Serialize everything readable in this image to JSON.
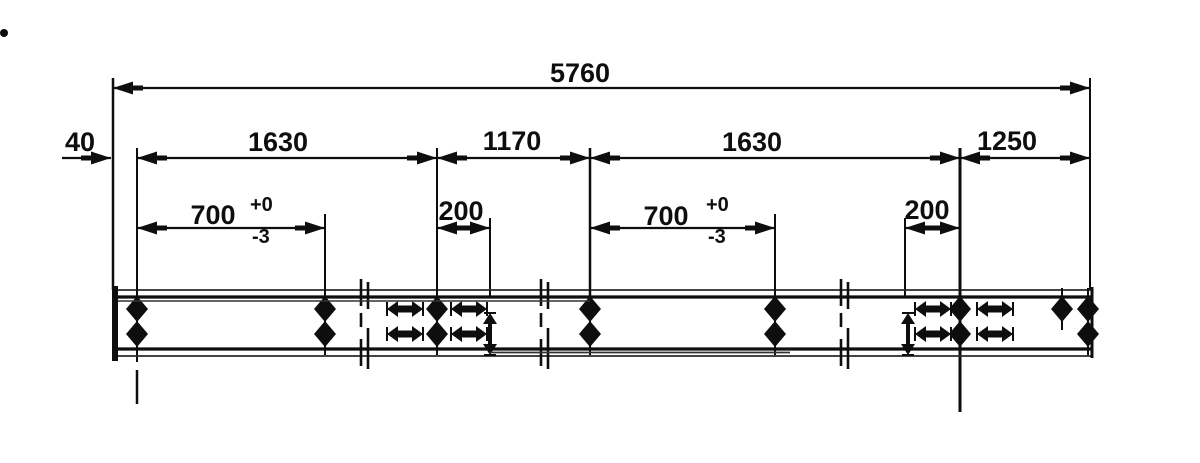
{
  "meta": {
    "kind": "engineering-dimension-drawing",
    "ink": "#0e0e0e",
    "paper": "#ffffff"
  },
  "dimensions": [
    {
      "value": "5760"
    },
    {
      "value": "40"
    },
    {
      "value": "1630"
    },
    {
      "value": "1170"
    },
    {
      "value": "1630"
    },
    {
      "value": "1250"
    },
    {
      "value": "700",
      "tolerance_plus": "+0",
      "tolerance_minus": "-3"
    },
    {
      "value": "200"
    },
    {
      "value": "700",
      "tolerance_plus": "+0",
      "tolerance_minus": "-3"
    },
    {
      "value": "200"
    }
  ],
  "drawing": {
    "width": 1200,
    "height": 463,
    "dim_rows": [
      {
        "name": "overall-5760",
        "label": "5760",
        "x1": 113,
        "x2": 1090,
        "y": 88,
        "label_x": 580,
        "label_y": 82
      },
      {
        "name": "offset-40",
        "label": "40",
        "x1": 62,
        "x2": 111,
        "y": 158,
        "label_x": 80,
        "label_y": 151,
        "arrows": "right-only"
      },
      {
        "name": "span-1630-left",
        "label": "1630",
        "x1": 137,
        "x2": 437,
        "y": 158,
        "label_x": 278,
        "label_y": 151
      },
      {
        "name": "span-1170",
        "label": "1170",
        "x1": 437,
        "x2": 590,
        "y": 158,
        "label_x": 512,
        "label_y": 150
      },
      {
        "name": "span-1630-right",
        "label": "1630",
        "x1": 590,
        "x2": 960,
        "y": 158,
        "label_x": 752,
        "label_y": 151
      },
      {
        "name": "span-1250",
        "label": "1250",
        "x1": 960,
        "x2": 1090,
        "y": 158,
        "label_x": 1007,
        "label_y": 150
      },
      {
        "name": "span-700-left",
        "label": "700",
        "tol_plus": "+0",
        "tol_minus": "-3",
        "x1": 137,
        "x2": 325,
        "y": 228,
        "label_x": 213,
        "label_y": 224,
        "tol_x": 250
      },
      {
        "name": "span-200-left",
        "label": "200",
        "x1": 437,
        "x2": 490,
        "y": 228,
        "label_x": 461,
        "label_y": 220
      },
      {
        "name": "span-700-right",
        "label": "700",
        "tol_plus": "+0",
        "tol_minus": "-3",
        "x1": 590,
        "x2": 775,
        "y": 228,
        "label_x": 666,
        "label_y": 225,
        "tol_x": 706
      },
      {
        "name": "span-200-right",
        "label": "200",
        "x1": 905,
        "x2": 960,
        "y": 228,
        "label_x": 927,
        "label_y": 219
      }
    ],
    "ext_lines": [
      {
        "x": 113,
        "y1": 78,
        "y2": 290,
        "w": 2.5
      },
      {
        "x": 1090,
        "y1": 78,
        "y2": 290,
        "w": 2
      },
      {
        "x": 137,
        "y1": 148,
        "y2": 362,
        "w": 2
      },
      {
        "x": 137,
        "y1": 370,
        "y2": 404,
        "w": 2.5
      },
      {
        "x": 437,
        "y1": 148,
        "y2": 300,
        "w": 2
      },
      {
        "x": 590,
        "y1": 148,
        "y2": 303,
        "w": 2.5
      },
      {
        "x": 960,
        "y1": 148,
        "y2": 412,
        "w": 3
      },
      {
        "x": 325,
        "y1": 214,
        "y2": 300,
        "w": 2
      },
      {
        "x": 490,
        "y1": 218,
        "y2": 296,
        "w": 2
      },
      {
        "x": 775,
        "y1": 214,
        "y2": 303,
        "w": 2
      },
      {
        "x": 905,
        "y1": 218,
        "y2": 296,
        "w": 2
      }
    ],
    "beam": {
      "x1": 113,
      "x2": 1093,
      "top_outer": 290,
      "top_inner": 297,
      "bot_inner": 349,
      "bot_outer": 356,
      "cap_left_x": 115,
      "cap_right_x": 1092
    },
    "breaks": [
      365,
      545,
      845
    ],
    "sym_rows": {
      "top": 309,
      "bottom": 334
    },
    "symbols": [
      {
        "type": "diamond",
        "x": 137,
        "rows": [
          "top",
          "bottom"
        ]
      },
      {
        "type": "diamond",
        "x": 325,
        "rows": [
          "top",
          "bottom"
        ]
      },
      {
        "type": "h-arrow",
        "x": 405,
        "rows": [
          "top",
          "bottom"
        ]
      },
      {
        "type": "diamond",
        "x": 437,
        "rows": [
          "top",
          "bottom"
        ]
      },
      {
        "type": "h-arrow",
        "x": 469,
        "rows": [
          "top",
          "bottom"
        ]
      },
      {
        "type": "v-arrow",
        "x": 490,
        "rows": [
          "bottom"
        ]
      },
      {
        "type": "diamond",
        "x": 590,
        "rows": [
          "top",
          "bottom"
        ]
      },
      {
        "type": "diamond",
        "x": 775,
        "rows": [
          "top",
          "bottom"
        ]
      },
      {
        "type": "v-arrow",
        "x": 908,
        "rows": [
          "bottom"
        ]
      },
      {
        "type": "h-arrow",
        "x": 933,
        "rows": [
          "top",
          "bottom"
        ]
      },
      {
        "type": "diamond",
        "x": 960,
        "rows": [
          "top",
          "bottom"
        ]
      },
      {
        "type": "h-arrow",
        "x": 995,
        "rows": [
          "top",
          "bottom"
        ]
      },
      {
        "type": "diamond",
        "x": 1062,
        "rows": [
          "top"
        ]
      },
      {
        "type": "diamond",
        "x": 1088,
        "rows": [
          "top",
          "bottom"
        ]
      }
    ],
    "artifacts": [
      {
        "type": "speck",
        "x": 4,
        "y": 33,
        "r": 4
      },
      {
        "type": "stroke",
        "x1": 118,
        "y1": 301,
        "x2": 590,
        "y2": 301,
        "w": 1.5
      },
      {
        "type": "stroke",
        "x1": 490,
        "y1": 352.5,
        "x2": 790,
        "y2": 352.5,
        "w": 1.8
      }
    ]
  }
}
